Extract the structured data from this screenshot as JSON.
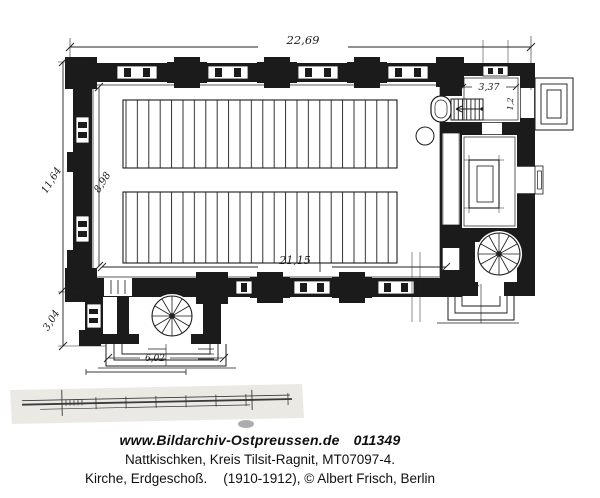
{
  "caption": {
    "site": "www.Bildarchiv-Ostpreussen.de",
    "image_id": "011349",
    "location": "Nattkischken, Kreis Tilsit-Ragnit, MT07097-4.",
    "subject": "Kirche, Erdgeschoß.",
    "credit": "(1910-1912), © Albert Frisch, Berlin"
  },
  "plan": {
    "dimensions": {
      "total_length": "22,69",
      "interior_length": "21,15",
      "exterior_width": "11,64",
      "interior_width": "8,98",
      "porch_depth": "3,04",
      "porch_width": "6,02",
      "sacristy_width": "3,37",
      "side_entrance_width": "1,67",
      "door_width": "1,2"
    }
  },
  "colors": {
    "ink": "#1b1b1b",
    "paper": "#ffffff",
    "scan_band": "#ebe9e4"
  }
}
